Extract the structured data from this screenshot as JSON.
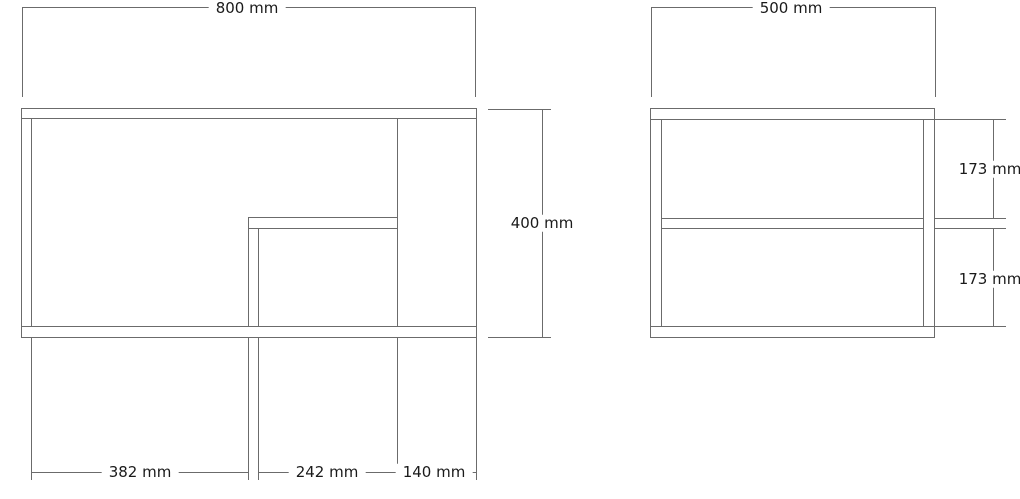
{
  "drawing": {
    "description": "cabinet technical drawing, two orthographic views",
    "dimensions": {
      "front_width": "800 mm",
      "front_height": "400 mm",
      "front_section_left": "382 mm",
      "front_section_middle": "242 mm",
      "front_section_right": "140 mm",
      "side_width": "500 mm",
      "side_upper_compartment": "173 mm",
      "side_lower_compartment": "173 mm"
    },
    "colors": {
      "line": "#6b6b6b",
      "text": "#1a1a1a",
      "background": "#ffffff"
    }
  }
}
